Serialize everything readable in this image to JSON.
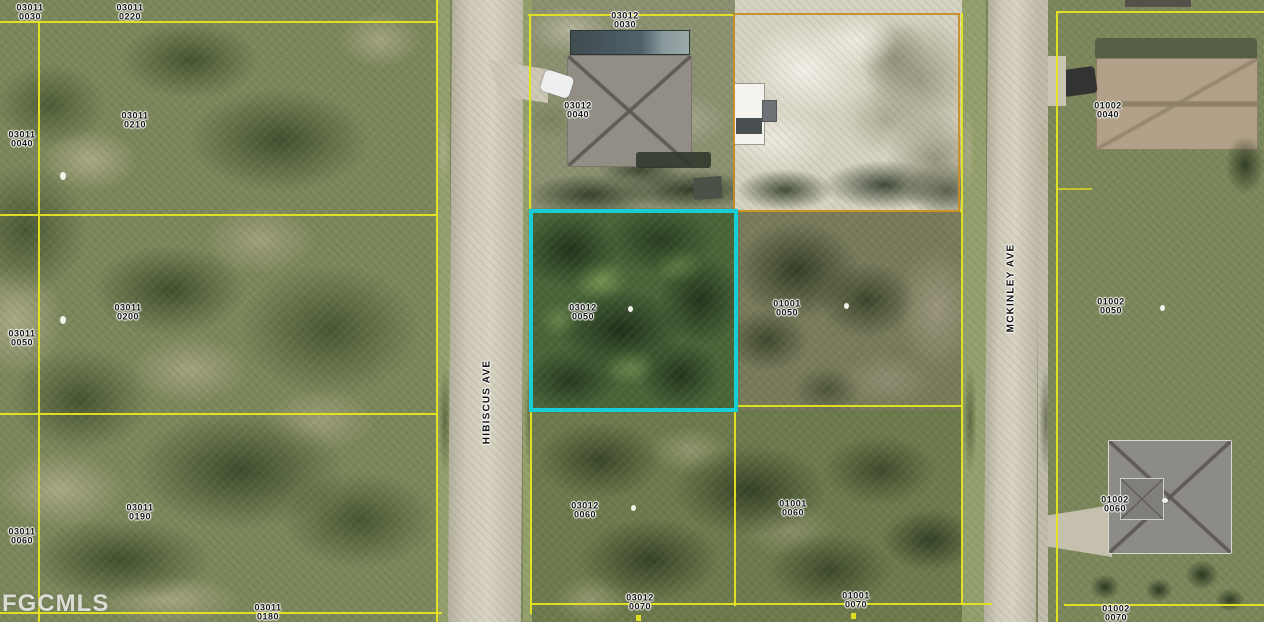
{
  "watermark": "FGCMLS",
  "streets": {
    "hibiscus": "HIBISCUS AVE",
    "mckinley": "MCKINLEY AVE"
  },
  "colors": {
    "highlight": "#17CED6",
    "parcel_line": "#E6E420",
    "block_line": "#C88C23"
  },
  "highlighted_parcel": "03012 0050",
  "parcels": [
    {
      "id": "03011 0030",
      "line1": "03011",
      "line2": "0030"
    },
    {
      "id": "03011 0220",
      "line1": "03011",
      "line2": "0220"
    },
    {
      "id": "03011 0040",
      "line1": "03011",
      "line2": "0040"
    },
    {
      "id": "03011 0210",
      "line1": "03011",
      "line2": "0210"
    },
    {
      "id": "03011 0050",
      "line1": "03011",
      "line2": "0050"
    },
    {
      "id": "03011 0200",
      "line1": "03011",
      "line2": "0200"
    },
    {
      "id": "03011 0060",
      "line1": "03011",
      "line2": "0060"
    },
    {
      "id": "03011 0190",
      "line1": "03011",
      "line2": "0190"
    },
    {
      "id": "03011 0180",
      "line1": "03011",
      "line2": "0180"
    },
    {
      "id": "03012 0030",
      "line1": "03012",
      "line2": "0030"
    },
    {
      "id": "03012 0040",
      "line1": "03012",
      "line2": "0040"
    },
    {
      "id": "03012 0050",
      "line1": "03012",
      "line2": "0050"
    },
    {
      "id": "03012 0060",
      "line1": "03012",
      "line2": "0060"
    },
    {
      "id": "03012 0070",
      "line1": "03012",
      "line2": "0070"
    },
    {
      "id": "01001 0050",
      "line1": "01001",
      "line2": "0050"
    },
    {
      "id": "01001 0060",
      "line1": "01001",
      "line2": "0060"
    },
    {
      "id": "01001 0070",
      "line1": "01001",
      "line2": "0070"
    },
    {
      "id": "01002 0040",
      "line1": "01002",
      "line2": "0040"
    },
    {
      "id": "01002 0050",
      "line1": "01002",
      "line2": "0050"
    },
    {
      "id": "01002 0060",
      "line1": "01002",
      "line2": "0060"
    },
    {
      "id": "01002 0070",
      "line1": "01002",
      "line2": "0070"
    }
  ]
}
